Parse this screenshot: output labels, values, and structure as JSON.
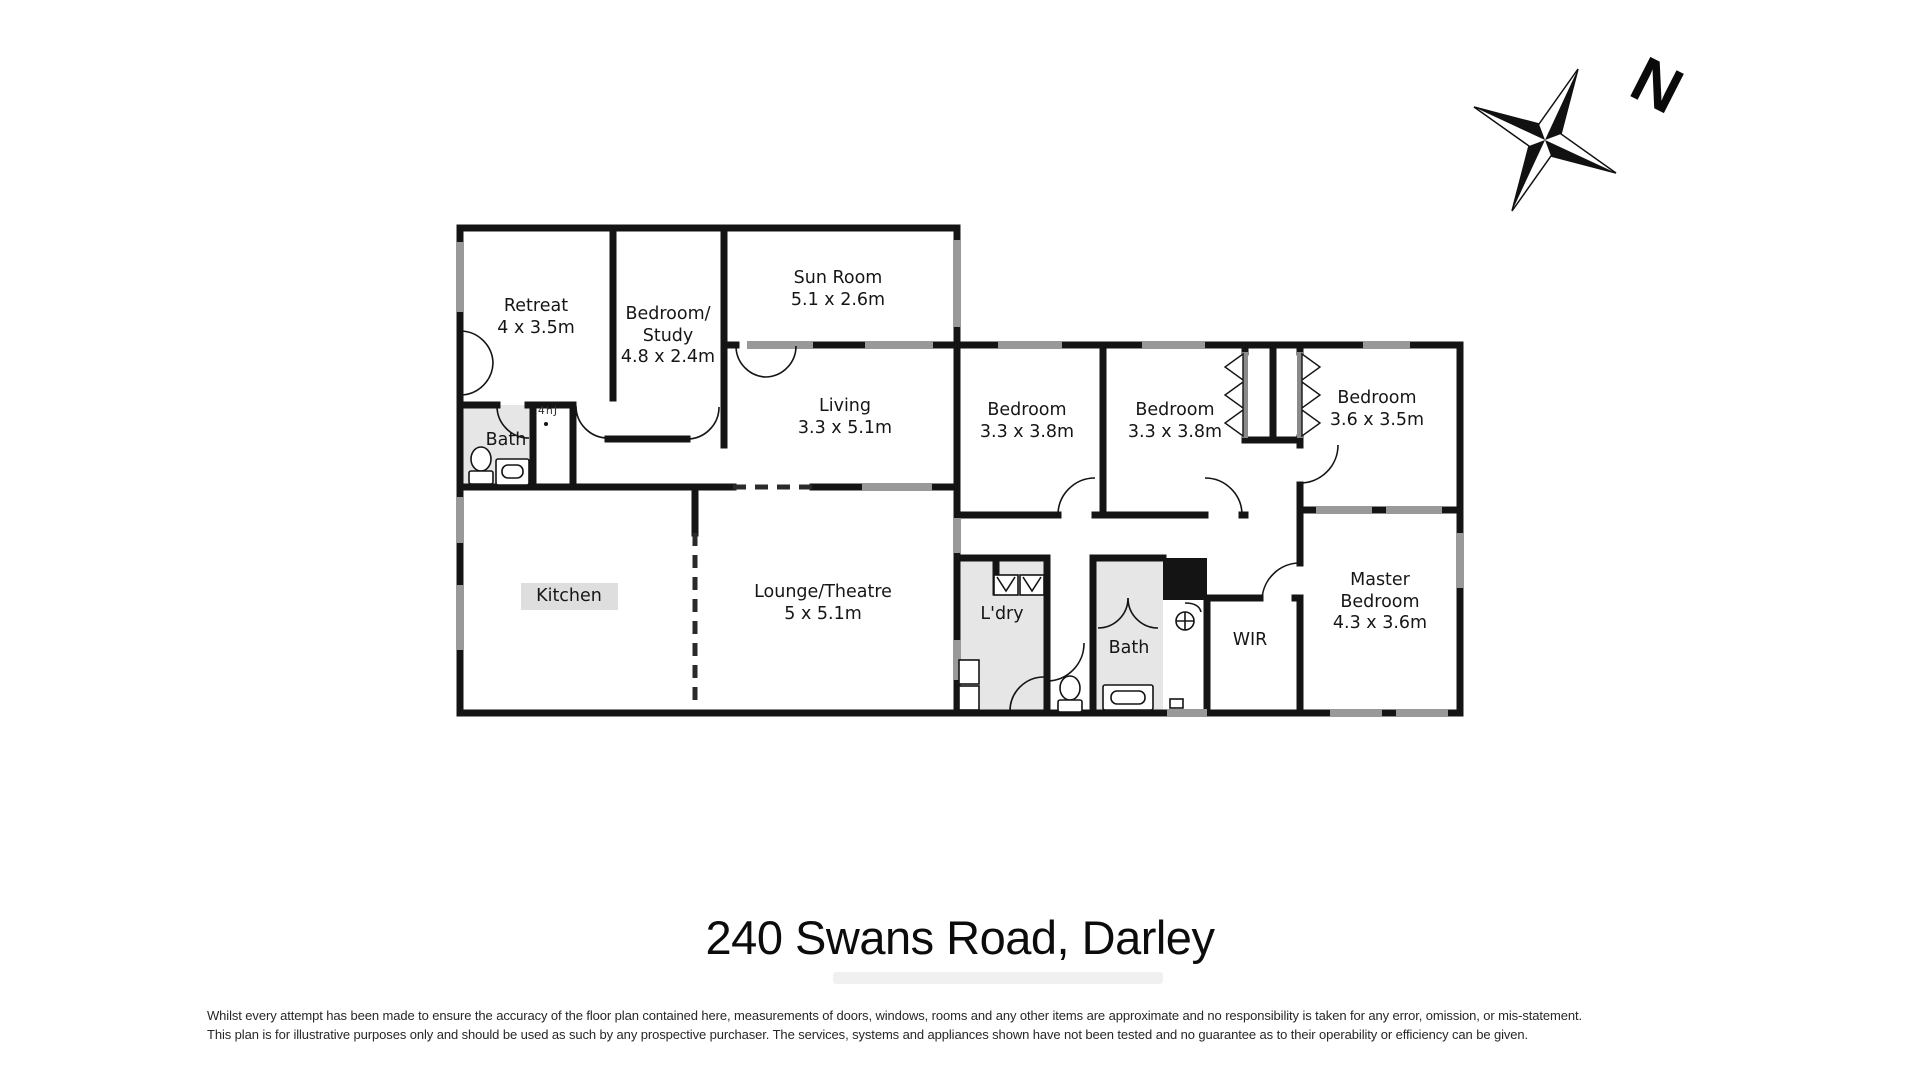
{
  "title": "240 Swans Road, Darley",
  "compass": {
    "north_label": "N"
  },
  "rooms": [
    {
      "id": "retreat",
      "lines": [
        "Retreat",
        "4 x 3.5m"
      ]
    },
    {
      "id": "bedroom-study",
      "lines": [
        "Bedroom/",
        "Study",
        "4.8 x 2.4m"
      ]
    },
    {
      "id": "sun-room",
      "lines": [
        "Sun Room",
        "5.1 x 2.6m"
      ]
    },
    {
      "id": "living",
      "lines": [
        "Living",
        "3.3 x 5.1m"
      ]
    },
    {
      "id": "bedroom-1",
      "lines": [
        "Bedroom",
        "3.3 x 3.8m"
      ]
    },
    {
      "id": "bedroom-2",
      "lines": [
        "Bedroom",
        "3.3 x 3.8m"
      ]
    },
    {
      "id": "bedroom-3",
      "lines": [
        "Bedroom",
        "3.6 x 3.5m"
      ]
    },
    {
      "id": "bath-upper",
      "lines": [
        "Bath"
      ]
    },
    {
      "id": "kitchen",
      "lines": [
        "Kitchen"
      ]
    },
    {
      "id": "lounge-theatre",
      "lines": [
        "Lounge/Theatre",
        "5 x 5.1m"
      ]
    },
    {
      "id": "laundry",
      "lines": [
        "L'dry"
      ]
    },
    {
      "id": "bath-lower",
      "lines": [
        "Bath"
      ]
    },
    {
      "id": "wir",
      "lines": [
        "WIR"
      ]
    },
    {
      "id": "master-bedroom",
      "lines": [
        "Master",
        "Bedroom",
        "4.3 x 3.6m"
      ]
    }
  ],
  "annotations": {
    "tiny_label": "4hJ"
  },
  "disclaimer": {
    "line1": "Whilst every attempt has been made to ensure the accuracy of the floor plan contained here, measurements of doors, windows, rooms and any other items are approximate and no responsibility is taken for any error, omission, or mis-statement.",
    "line2": "This plan is for illustrative purposes only and should be used as such by any prospective purchaser. The services, systems and appliances shown have not been tested and no guarantee as to their operability or efficiency can be given."
  },
  "colors": {
    "wall": "#141414",
    "window": "#999999",
    "wet_area_fill": "#e6e6e6",
    "label_highlight": "#dedede"
  }
}
